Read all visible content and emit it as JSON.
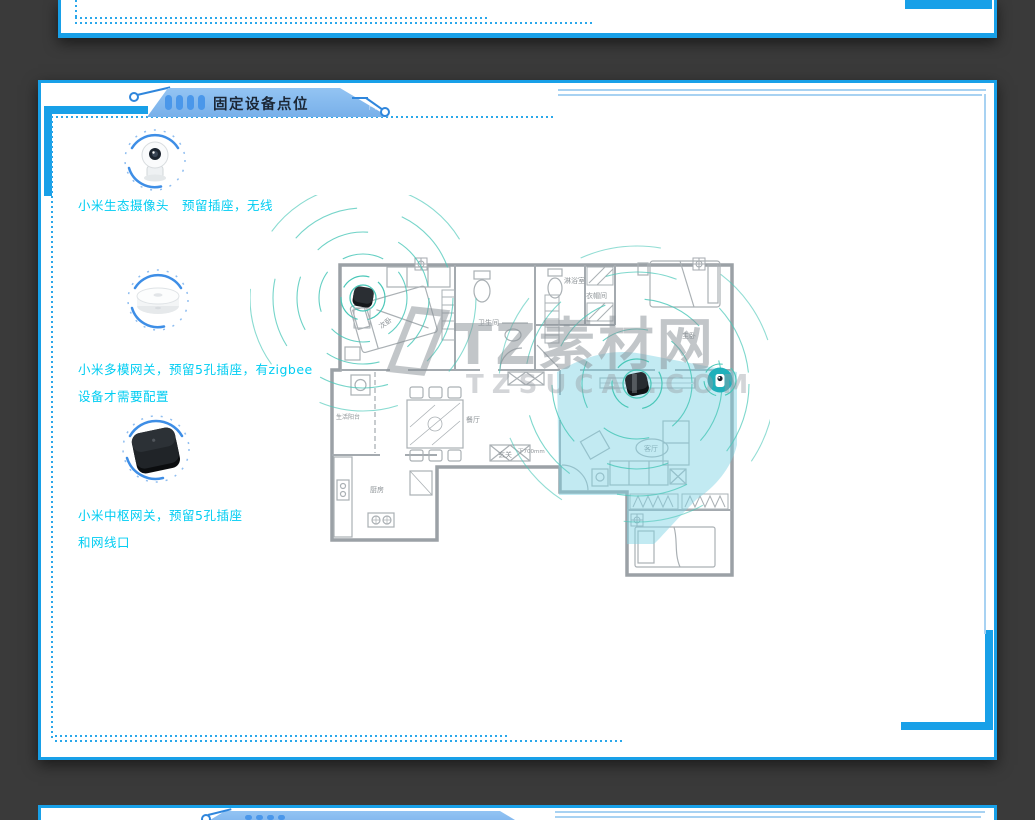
{
  "colors": {
    "background": "#3a3a3a",
    "accent_blue": "#18a0e8",
    "tab_fill": "#85bbee",
    "tab_bar": "#4a97ea",
    "label_cyan": "#00cdf2",
    "signal_teal": "#49c7b8",
    "coverage_cyan": "#80d3e3",
    "watermark_gray": "#8a9197"
  },
  "header_tab": {
    "title": "固定设备点位"
  },
  "devices": [
    {
      "id": "camera",
      "label": "小米生态摄像头　预留插座，无线",
      "label2": ""
    },
    {
      "id": "multimode-gateway",
      "label": "小米多模网关，预留5孔插座，有zigbee",
      "label2": "设备才需要配置"
    },
    {
      "id": "hub-gateway",
      "label": "小米中枢网关，预留5孔插座",
      "label2": "和网线口"
    }
  ],
  "floorplan": {
    "rooms": [
      {
        "label": "次卧"
      },
      {
        "label": "卫生间"
      },
      {
        "label": "淋浴室"
      },
      {
        "label": "衣帽间"
      },
      {
        "label": "主卧"
      },
      {
        "label": "玄关"
      },
      {
        "label": "餐厅"
      },
      {
        "label": "生活阳台"
      },
      {
        "label": "厨房"
      },
      {
        "label": "客厅"
      }
    ],
    "annotation": "下700mm"
  },
  "watermark": {
    "title": "TZ素材网",
    "subtitle": "TZSUCAI.COM"
  }
}
